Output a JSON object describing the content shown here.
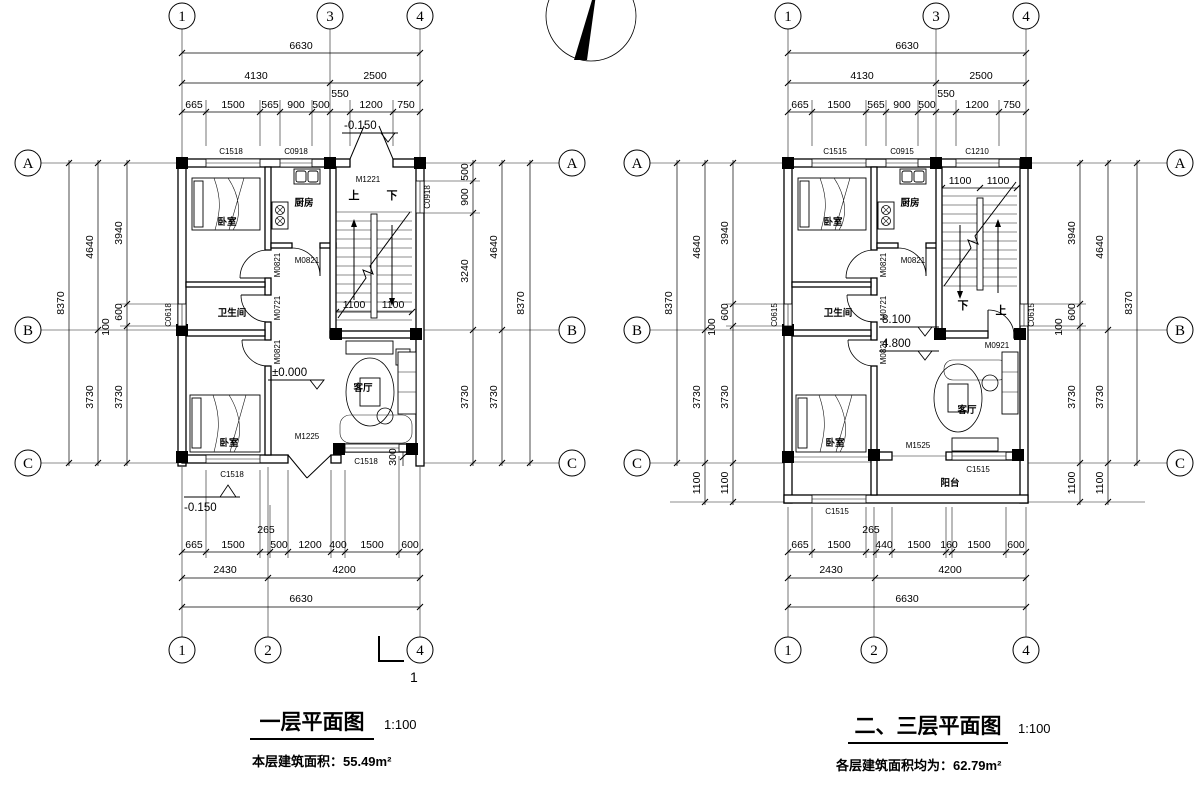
{
  "icons": {
    "compass": "north-arrow"
  },
  "plan1": {
    "title": "一层平面图",
    "scale": "1:100",
    "area_note": "本层建筑面积：55.49m²",
    "grid": {
      "top": [
        "1",
        "3",
        "4"
      ],
      "bottom": [
        "1",
        "2",
        "4"
      ],
      "left": [
        "A",
        "B",
        "C"
      ],
      "right": [
        "A",
        "B",
        "C"
      ]
    },
    "dims": {
      "top_total": "6630",
      "top_mid": [
        "4130",
        "2500"
      ],
      "top_detail": [
        "665",
        "1500",
        "565",
        "900",
        "500",
        "550",
        "1200",
        "750"
      ],
      "bottom_detail": [
        "665",
        "1500",
        "265",
        "500",
        "1200",
        "400",
        "1500",
        "600"
      ],
      "bottom_mid": [
        "2430",
        "4200"
      ],
      "bottom_total": "6630",
      "left_outer": "8370",
      "left_mid": [
        "4640",
        "3730"
      ],
      "left_inner": [
        "3940",
        "600",
        "100",
        "3730"
      ],
      "right_outer": "8370",
      "right_mid": [
        "4640",
        "3730"
      ],
      "right_inner": [
        "500",
        "900",
        "3240",
        "3730"
      ],
      "stair": [
        "1100",
        "1100"
      ],
      "bay_offset": "300"
    },
    "levels": {
      "entry": "-0.150",
      "floor": "±0.000",
      "ground": "-0.150"
    },
    "windows": {
      "top_1": "C1518",
      "top_2": "C0918",
      "left": "C0618",
      "right": "C0918",
      "bottom_1": "C1518",
      "bottom_2": "C1518"
    },
    "doors": {
      "entry": "M1221",
      "kitchen": "M0821",
      "bedroom1": "M0821",
      "bathroom": "M0721",
      "bedroom2": "M0821",
      "living": "M1225"
    },
    "rooms": {
      "bedroom1": "卧室",
      "kitchen": "厨房",
      "bathroom": "卫生间",
      "bedroom2": "卧室",
      "living": "客厅"
    },
    "stair_text": {
      "up": "上",
      "down": "下"
    },
    "section_mark": "1"
  },
  "plan23": {
    "title": "二、三层平面图",
    "scale": "1:100",
    "area_note": "各层建筑面积均为：62.79m²",
    "grid": {
      "top": [
        "1",
        "3",
        "4"
      ],
      "bottom": [
        "1",
        "2",
        "4"
      ],
      "left": [
        "A",
        "B",
        "C"
      ],
      "right": [
        "A",
        "B",
        "C"
      ]
    },
    "dims": {
      "top_total": "6630",
      "top_mid": [
        "4130",
        "2500"
      ],
      "top_detail": [
        "665",
        "1500",
        "565",
        "900",
        "500",
        "550",
        "1200",
        "750"
      ],
      "bottom_detail": [
        "665",
        "1500",
        "265",
        "440",
        "1500",
        "160",
        "1500",
        "600"
      ],
      "bottom_mid": [
        "2430",
        "4200"
      ],
      "bottom_total": "6630",
      "left_outer": "8370",
      "left_mid": [
        "4640",
        "3730"
      ],
      "left_inner": [
        "3940",
        "600",
        "100",
        "3730"
      ],
      "right_outer": "8370",
      "right_mid": [
        "4640",
        "3730"
      ],
      "right_inner": [
        "3940",
        "600",
        "100",
        "3730"
      ],
      "balcony_left": [
        "1100",
        "1100"
      ],
      "balcony_right": [
        "1100",
        "1100"
      ],
      "stair": [
        "1100",
        "1100"
      ]
    },
    "levels": {
      "floor3": "8.100",
      "floor2": "4.800"
    },
    "windows": {
      "top_1": "C1515",
      "top_2": "C0915",
      "top_3": "C1210",
      "left": "C0615",
      "right": "C0615",
      "bottom_1": "C1515",
      "living_south": "C1515"
    },
    "doors": {
      "kitchen": "M0821",
      "bedroom1": "M0821",
      "bathroom": "M0721",
      "bedroom2": "M0821",
      "stair": "M0921",
      "balcony": "M1525"
    },
    "rooms": {
      "bedroom1": "卧室",
      "kitchen": "厨房",
      "bathroom": "卫生间",
      "bedroom2": "卧室",
      "living": "客厅",
      "balcony": "阳台"
    },
    "stair_text": {
      "up": "上",
      "down": "下"
    }
  }
}
